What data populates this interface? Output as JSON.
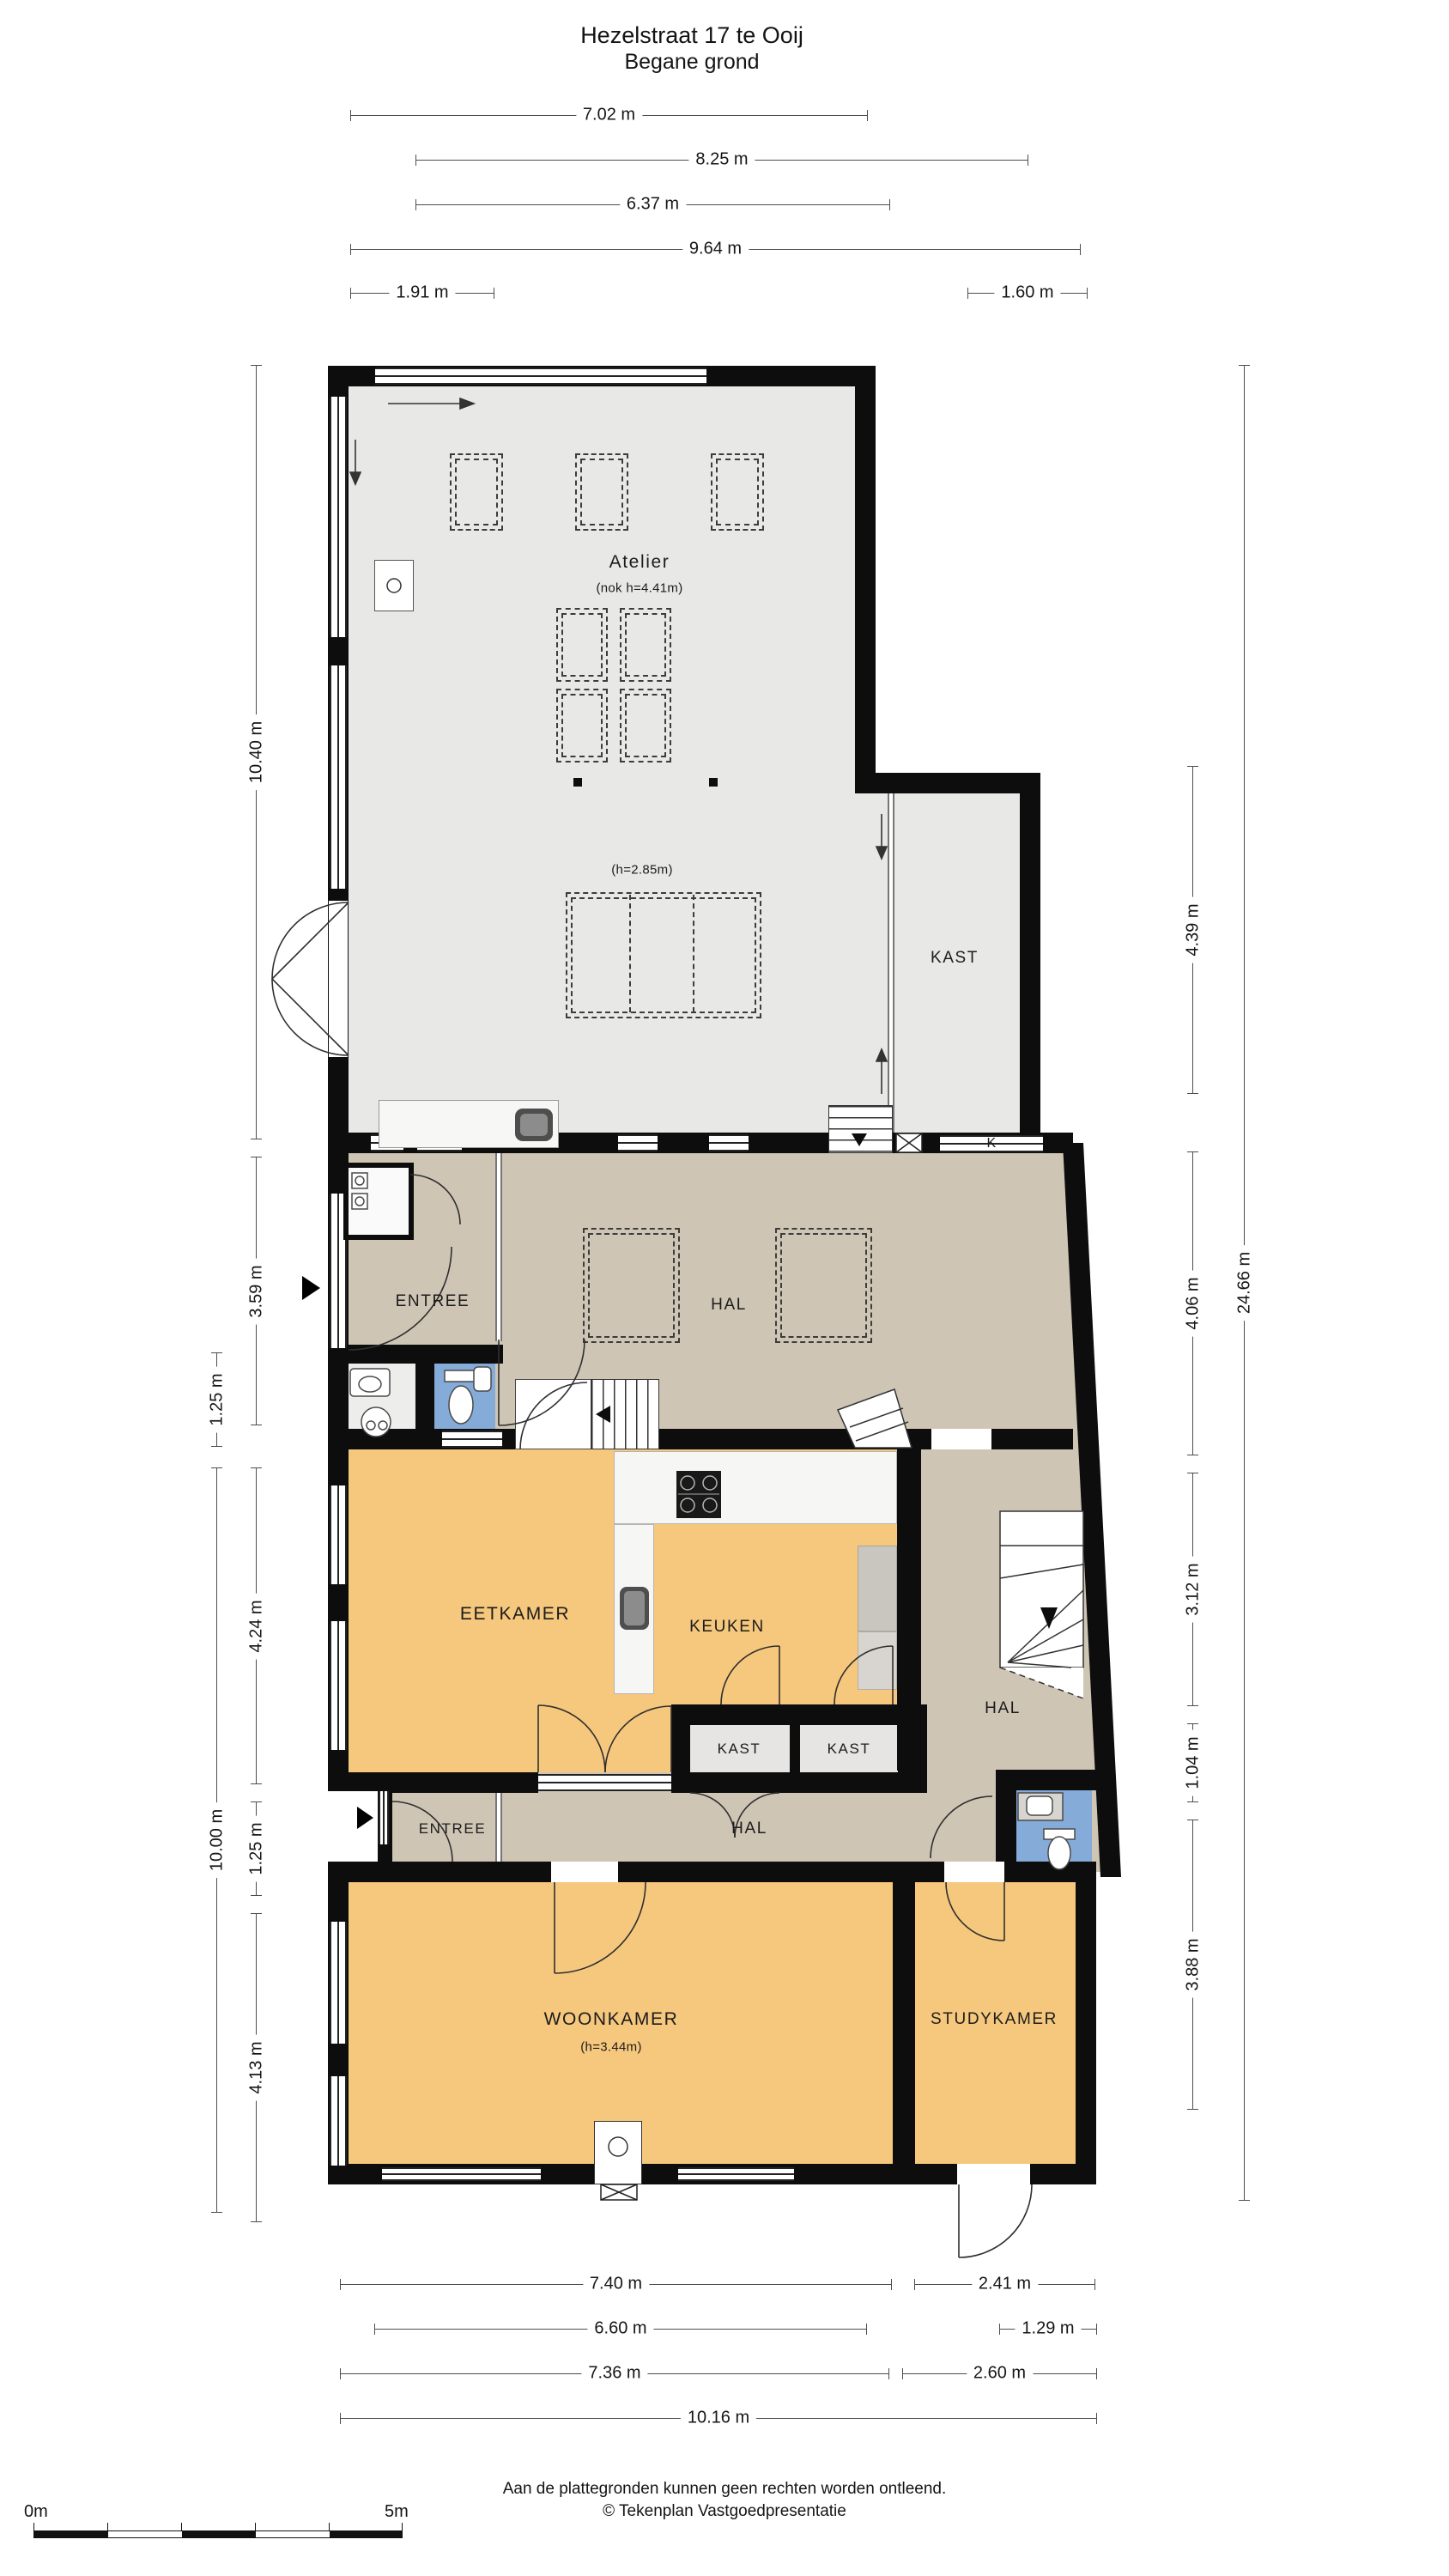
{
  "title": {
    "line1": "Hezelstraat 17 te Ooij",
    "line2": "Begane grond"
  },
  "rooms": {
    "atelier": "Atelier",
    "atelier_note": "(nok h=4.41m)",
    "atelier_note2": "(h=2.85m)",
    "kast_atelier": "KAST",
    "k_door": "K",
    "entree_upper": "ENTREE",
    "hal_upper": "HAL",
    "eetkamer": "EETKAMER",
    "keuken": "KEUKEN",
    "hal_right": "HAL",
    "kast_1": "KAST",
    "kast_2": "KAST",
    "entree_lower": "ENTREE",
    "hal_lower": "HAL",
    "woonkamer": "WOONKAMER",
    "woonkamer_note": "(h=3.44m)",
    "studykamer": "STUDYKAMER"
  },
  "dimensions": {
    "top": [
      "7.02 m",
      "8.25 m",
      "6.37 m",
      "9.64 m",
      "1.91 m",
      "1.60 m"
    ],
    "left": [
      "10.40 m",
      "3.59 m",
      "1.25 m",
      "4.24 m",
      "10.00 m",
      "1.25 m",
      "4.13 m"
    ],
    "right": [
      "4.39 m",
      "4.06 m",
      "3.12 m",
      "1.04 m",
      "3.88 m",
      "24.66 m"
    ],
    "bottom": [
      "7.40 m",
      "2.41 m",
      "6.60 m",
      "1.29 m",
      "7.36 m",
      "2.60 m",
      "10.16 m"
    ]
  },
  "scale_bar": {
    "start": "0m",
    "end": "5m"
  },
  "footer": {
    "line1": "Aan de plattegronden kunnen geen rechten worden ontleend.",
    "line2": "© Tekenplan Vastgoedpresentatie"
  },
  "colors": {
    "wall": "#0d0d0d",
    "floor_grey": "#e8e8e7",
    "floor_tan": "#cfc5b5",
    "floor_orange": "#f6c87d",
    "floor_closet": "#e6e5e3",
    "floor_blue": "#85abd8"
  }
}
